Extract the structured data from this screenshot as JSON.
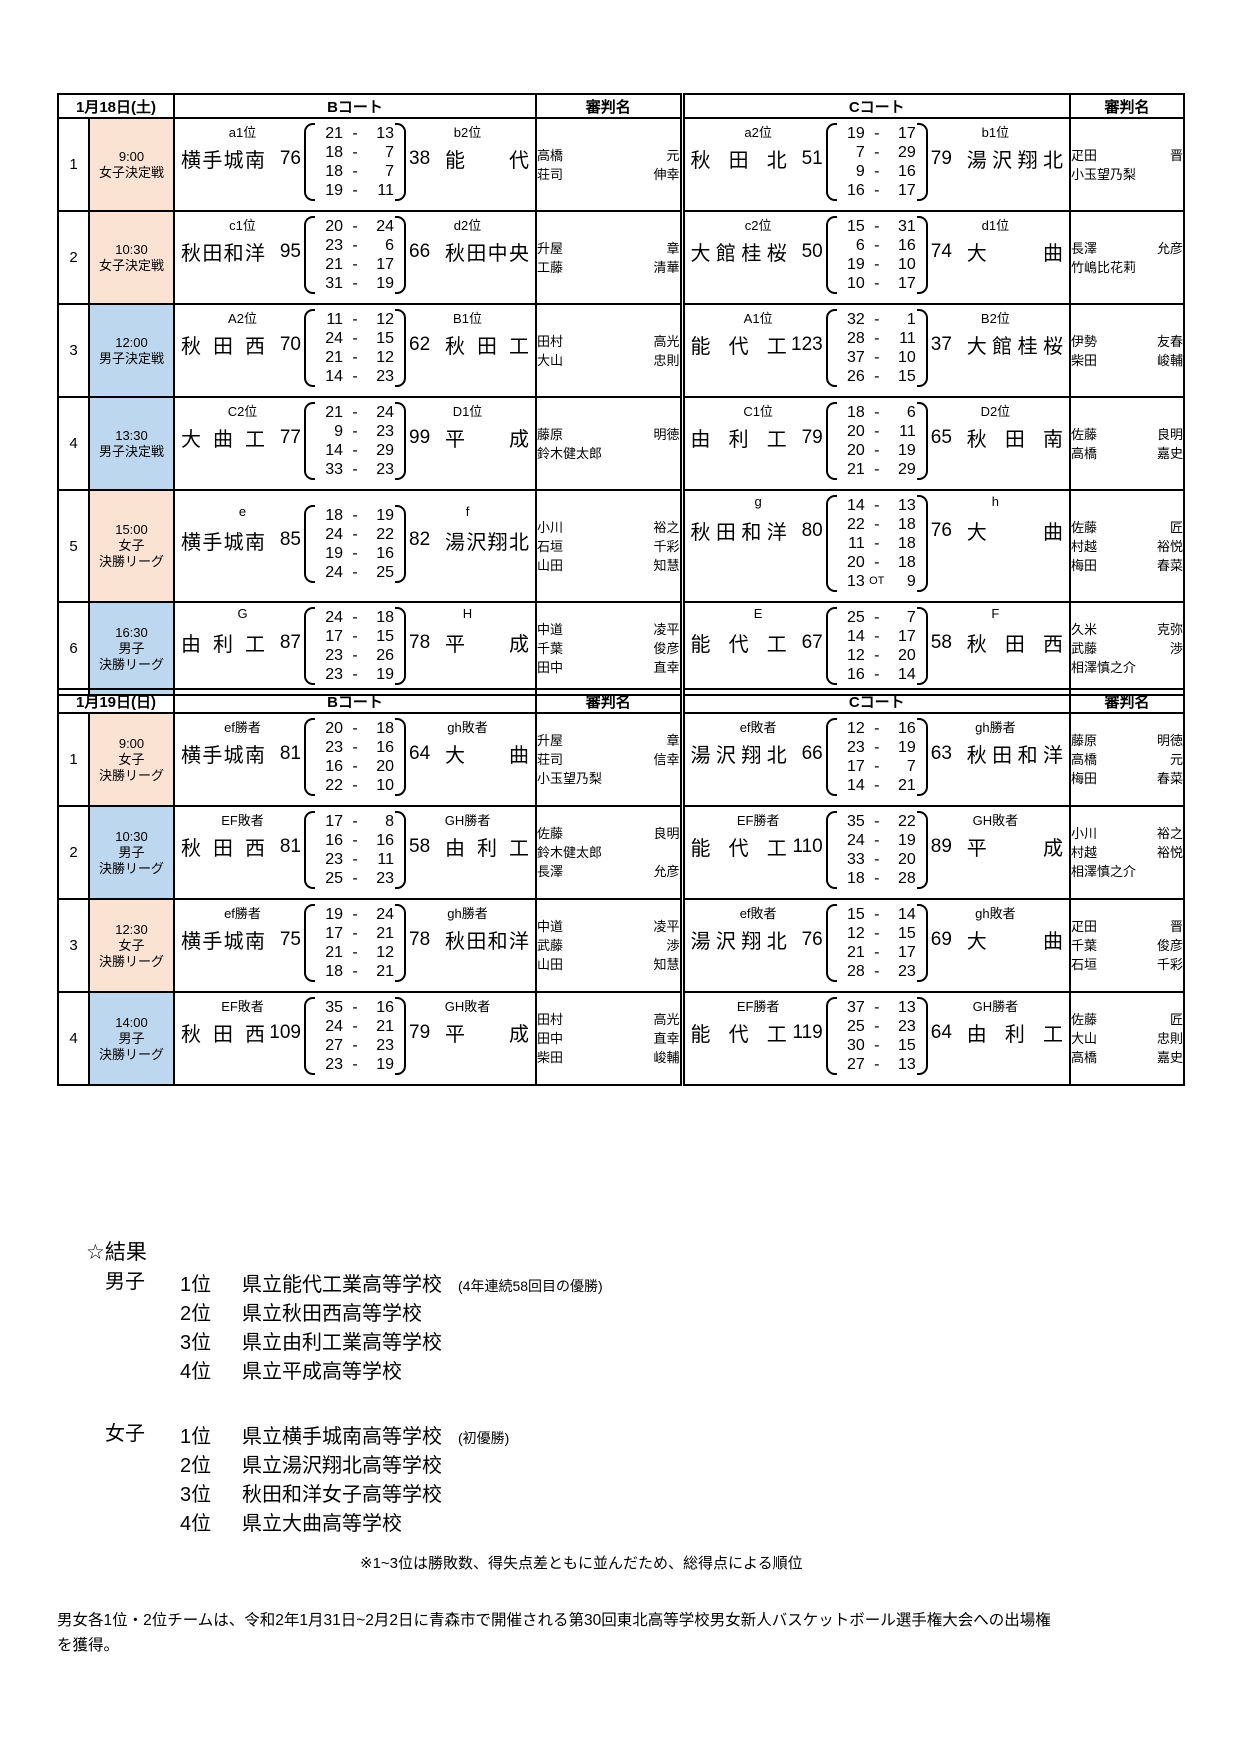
{
  "ui": {
    "dash": "-"
  },
  "colors": {
    "girls": "#fbe3d3",
    "boys": "#bdd7ee"
  },
  "day1": {
    "date": "1月18日(土)",
    "headers": {
      "court_b": "Bコート",
      "referee_b": "審判名",
      "court_c": "Cコート",
      "referee_c": "審判名"
    },
    "rows": [
      {
        "no": "1",
        "time": "9:00",
        "type_lines": [
          "女子決定戦"
        ],
        "gender": "girls",
        "b": {
          "seed_l": "a1位",
          "team_l": "横手城南",
          "score_l": "76",
          "quarters": [
            [
              "21",
              "13"
            ],
            [
              "18",
              "7"
            ],
            [
              "18",
              "7"
            ],
            [
              "19",
              "11"
            ]
          ],
          "score_r": "38",
          "team_r": "能代",
          "seed_r": "b2位",
          "refs": [
            [
              "高橋",
              "元"
            ],
            [
              "荘司",
              "伸幸"
            ]
          ]
        },
        "c": {
          "seed_l": "a2位",
          "team_l": "秋田北",
          "score_l": "51",
          "quarters": [
            [
              "19",
              "17"
            ],
            [
              "7",
              "29"
            ],
            [
              "9",
              "16"
            ],
            [
              "16",
              "17"
            ]
          ],
          "score_r": "79",
          "team_r": "湯沢翔北",
          "seed_r": "b1位",
          "refs": [
            [
              "疋田",
              "晋"
            ],
            [
              "小玉望乃梨"
            ]
          ]
        }
      },
      {
        "no": "2",
        "time": "10:30",
        "type_lines": [
          "女子決定戦"
        ],
        "gender": "girls",
        "b": {
          "seed_l": "c1位",
          "team_l": "秋田和洋",
          "score_l": "95",
          "quarters": [
            [
              "20",
              "24"
            ],
            [
              "23",
              "6"
            ],
            [
              "21",
              "17"
            ],
            [
              "31",
              "19"
            ]
          ],
          "score_r": "66",
          "team_r": "秋田中央",
          "seed_r": "d2位",
          "refs": [
            [
              "升屋",
              "章"
            ],
            [
              "工藤",
              "清華"
            ]
          ]
        },
        "c": {
          "seed_l": "c2位",
          "team_l": "大館桂桜",
          "score_l": "50",
          "quarters": [
            [
              "15",
              "31"
            ],
            [
              "6",
              "16"
            ],
            [
              "19",
              "10"
            ],
            [
              "10",
              "17"
            ]
          ],
          "score_r": "74",
          "team_r": "大曲",
          "seed_r": "d1位",
          "refs": [
            [
              "長澤",
              "允彦"
            ],
            [
              "竹嶋比花莉"
            ]
          ]
        }
      },
      {
        "no": "3",
        "time": "12:00",
        "type_lines": [
          "男子決定戦"
        ],
        "gender": "boys",
        "b": {
          "seed_l": "A2位",
          "team_l": "秋田西",
          "score_l": "70",
          "quarters": [
            [
              "11",
              "12"
            ],
            [
              "24",
              "15"
            ],
            [
              "21",
              "12"
            ],
            [
              "14",
              "23"
            ]
          ],
          "score_r": "62",
          "team_r": "秋田工",
          "seed_r": "B1位",
          "refs": [
            [
              "田村",
              "高光"
            ],
            [
              "大山",
              "忠則"
            ]
          ]
        },
        "c": {
          "seed_l": "A1位",
          "team_l": "能代工",
          "score_l": "123",
          "quarters": [
            [
              "32",
              "1"
            ],
            [
              "28",
              "11"
            ],
            [
              "37",
              "10"
            ],
            [
              "26",
              "15"
            ]
          ],
          "score_r": "37",
          "team_r": "大館桂桜",
          "seed_r": "B2位",
          "refs": [
            [
              "伊勢",
              "友春"
            ],
            [
              "柴田",
              "峻輔"
            ]
          ]
        }
      },
      {
        "no": "4",
        "time": "13:30",
        "type_lines": [
          "男子決定戦"
        ],
        "gender": "boys",
        "b": {
          "seed_l": "C2位",
          "team_l": "大曲工",
          "score_l": "77",
          "quarters": [
            [
              "21",
              "24"
            ],
            [
              "9",
              "23"
            ],
            [
              "14",
              "29"
            ],
            [
              "33",
              "23"
            ]
          ],
          "score_r": "99",
          "team_r": "平成",
          "seed_r": "D1位",
          "refs": [
            [
              "藤原",
              "明徳"
            ],
            [
              "鈴木健太郎"
            ]
          ]
        },
        "c": {
          "seed_l": "C1位",
          "team_l": "由利工",
          "score_l": "79",
          "quarters": [
            [
              "18",
              "6"
            ],
            [
              "20",
              "11"
            ],
            [
              "20",
              "19"
            ],
            [
              "21",
              "29"
            ]
          ],
          "score_r": "65",
          "team_r": "秋田南",
          "seed_r": "D2位",
          "refs": [
            [
              "佐藤",
              "良明"
            ],
            [
              "高橋",
              "嘉史"
            ]
          ]
        }
      },
      {
        "no": "5",
        "time": "15:00",
        "type_lines": [
          "女子",
          "決勝リーグ"
        ],
        "gender": "girls",
        "b": {
          "seed_l": "e",
          "team_l": "横手城南",
          "score_l": "85",
          "quarters": [
            [
              "18",
              "19"
            ],
            [
              "24",
              "22"
            ],
            [
              "19",
              "16"
            ],
            [
              "24",
              "25"
            ]
          ],
          "score_r": "82",
          "team_r": "湯沢翔北",
          "seed_r": "f",
          "refs": [
            [
              "小川",
              "裕之"
            ],
            [
              "石垣",
              "千彩"
            ],
            [
              "山田",
              "知慧"
            ]
          ]
        },
        "c": {
          "seed_l": "g",
          "team_l": "秋田和洋",
          "score_l": "80",
          "quarters": [
            [
              "14",
              "13"
            ],
            [
              "22",
              "18"
            ],
            [
              "11",
              "18"
            ],
            [
              "20",
              "18"
            ],
            [
              "13",
              "9",
              "OT"
            ]
          ],
          "score_r": "76",
          "team_r": "大曲",
          "seed_r": "h",
          "refs": [
            [
              "佐藤",
              "匠"
            ],
            [
              "村越",
              "裕悦"
            ],
            [
              "梅田",
              "春菜"
            ]
          ]
        }
      },
      {
        "no": "6",
        "time": "16:30",
        "type_lines": [
          "男子",
          "決勝リーグ"
        ],
        "gender": "boys",
        "b": {
          "seed_l": "G",
          "team_l": "由利工",
          "score_l": "87",
          "quarters": [
            [
              "24",
              "18"
            ],
            [
              "17",
              "15"
            ],
            [
              "23",
              "26"
            ],
            [
              "23",
              "19"
            ]
          ],
          "score_r": "78",
          "team_r": "平成",
          "seed_r": "H",
          "refs": [
            [
              "中道",
              "凌平"
            ],
            [
              "千葉",
              "俊彦"
            ],
            [
              "田中",
              "直幸"
            ]
          ]
        },
        "c": {
          "seed_l": "E",
          "team_l": "能代工",
          "score_l": "67",
          "quarters": [
            [
              "25",
              "7"
            ],
            [
              "14",
              "17"
            ],
            [
              "12",
              "20"
            ],
            [
              "16",
              "14"
            ]
          ],
          "score_r": "58",
          "team_r": "秋田西",
          "seed_r": "F",
          "refs": [
            [
              "久米",
              "克弥"
            ],
            [
              "武藤",
              "渉"
            ],
            [
              "相澤慎之介"
            ]
          ]
        }
      }
    ]
  },
  "day2": {
    "date": "1月19日(日)",
    "headers": {
      "court_b": "Bコート",
      "referee_b": "審判名",
      "court_c": "Cコート",
      "referee_c": "審判名"
    },
    "rows": [
      {
        "no": "1",
        "time": "9:00",
        "type_lines": [
          "女子",
          "決勝リーグ"
        ],
        "gender": "girls",
        "b": {
          "seed_l": "ef勝者",
          "team_l": "横手城南",
          "score_l": "81",
          "quarters": [
            [
              "20",
              "18"
            ],
            [
              "23",
              "16"
            ],
            [
              "16",
              "20"
            ],
            [
              "22",
              "10"
            ]
          ],
          "score_r": "64",
          "team_r": "大曲",
          "seed_r": "gh敗者",
          "refs": [
            [
              "升屋",
              "章"
            ],
            [
              "荘司",
              "信幸"
            ],
            [
              "小玉望乃梨"
            ]
          ]
        },
        "c": {
          "seed_l": "ef敗者",
          "team_l": "湯沢翔北",
          "score_l": "66",
          "quarters": [
            [
              "12",
              "16"
            ],
            [
              "23",
              "19"
            ],
            [
              "17",
              "7"
            ],
            [
              "14",
              "21"
            ]
          ],
          "score_r": "63",
          "team_r": "秋田和洋",
          "seed_r": "gh勝者",
          "refs": [
            [
              "藤原",
              "明徳"
            ],
            [
              "高橋",
              "元"
            ],
            [
              "梅田",
              "春菜"
            ]
          ]
        }
      },
      {
        "no": "2",
        "time": "10:30",
        "type_lines": [
          "男子",
          "決勝リーグ"
        ],
        "gender": "boys",
        "b": {
          "seed_l": "EF敗者",
          "team_l": "秋田西",
          "score_l": "81",
          "quarters": [
            [
              "17",
              "8"
            ],
            [
              "16",
              "16"
            ],
            [
              "23",
              "11"
            ],
            [
              "25",
              "23"
            ]
          ],
          "score_r": "58",
          "team_r": "由利工",
          "seed_r": "GH勝者",
          "refs": [
            [
              "佐藤",
              "良明"
            ],
            [
              "鈴木健太郎"
            ],
            [
              "長澤",
              "允彦"
            ]
          ]
        },
        "c": {
          "seed_l": "EF勝者",
          "team_l": "能代工",
          "score_l": "110",
          "quarters": [
            [
              "35",
              "22"
            ],
            [
              "24",
              "19"
            ],
            [
              "33",
              "20"
            ],
            [
              "18",
              "28"
            ]
          ],
          "score_r": "89",
          "team_r": "平成",
          "seed_r": "GH敗者",
          "refs": [
            [
              "小川",
              "裕之"
            ],
            [
              "村越",
              "裕悦"
            ],
            [
              "相澤慎之介"
            ]
          ]
        }
      },
      {
        "no": "3",
        "time": "12:30",
        "type_lines": [
          "女子",
          "決勝リーグ"
        ],
        "gender": "girls",
        "b": {
          "seed_l": "ef勝者",
          "team_l": "横手城南",
          "score_l": "75",
          "quarters": [
            [
              "19",
              "24"
            ],
            [
              "17",
              "21"
            ],
            [
              "21",
              "12"
            ],
            [
              "18",
              "21"
            ]
          ],
          "score_r": "78",
          "team_r": "秋田和洋",
          "seed_r": "gh勝者",
          "refs": [
            [
              "中道",
              "凌平"
            ],
            [
              "武藤",
              "渉"
            ],
            [
              "山田",
              "知慧"
            ]
          ]
        },
        "c": {
          "seed_l": "ef敗者",
          "team_l": "湯沢翔北",
          "score_l": "76",
          "quarters": [
            [
              "15",
              "14"
            ],
            [
              "12",
              "15"
            ],
            [
              "21",
              "17"
            ],
            [
              "28",
              "23"
            ]
          ],
          "score_r": "69",
          "team_r": "大曲",
          "seed_r": "gh敗者",
          "refs": [
            [
              "疋田",
              "晋"
            ],
            [
              "千葉",
              "俊彦"
            ],
            [
              "石垣",
              "千彩"
            ]
          ]
        }
      },
      {
        "no": "4",
        "time": "14:00",
        "type_lines": [
          "男子",
          "決勝リーグ"
        ],
        "gender": "boys",
        "b": {
          "seed_l": "EF敗者",
          "team_l": "秋田西",
          "score_l": "109",
          "quarters": [
            [
              "35",
              "16"
            ],
            [
              "24",
              "21"
            ],
            [
              "27",
              "23"
            ],
            [
              "23",
              "19"
            ]
          ],
          "score_r": "79",
          "team_r": "平成",
          "seed_r": "GH敗者",
          "refs": [
            [
              "田村",
              "高光"
            ],
            [
              "田中",
              "直幸"
            ],
            [
              "柴田",
              "峻輔"
            ]
          ]
        },
        "c": {
          "seed_l": "EF勝者",
          "team_l": "能代工",
          "score_l": "119",
          "quarters": [
            [
              "37",
              "13"
            ],
            [
              "25",
              "23"
            ],
            [
              "30",
              "15"
            ],
            [
              "27",
              "13"
            ]
          ],
          "score_r": "64",
          "team_r": "由利工",
          "seed_r": "GH勝者",
          "refs": [
            [
              "佐藤",
              "匠"
            ],
            [
              "大山",
              "忠則"
            ],
            [
              "高橋",
              "嘉史"
            ]
          ]
        }
      }
    ]
  },
  "results": {
    "heading": "☆結果",
    "boys": {
      "label": "男子",
      "ranks": [
        {
          "rank": "1位",
          "school": "県立能代工業高等学校",
          "note": "(4年連続58回目の優勝)"
        },
        {
          "rank": "2位",
          "school": "県立秋田西高等学校"
        },
        {
          "rank": "3位",
          "school": "県立由利工業高等学校"
        },
        {
          "rank": "4位",
          "school": "県立平成高等学校"
        }
      ]
    },
    "girls": {
      "label": "女子",
      "ranks": [
        {
          "rank": "1位",
          "school": "県立横手城南高等学校",
          "note": "(初優勝)"
        },
        {
          "rank": "2位",
          "school": "県立湯沢翔北高等学校"
        },
        {
          "rank": "3位",
          "school": "秋田和洋女子高等学校"
        },
        {
          "rank": "4位",
          "school": "県立大曲高等学校"
        }
      ]
    },
    "note": "※1~3位は勝敗数、得失点差ともに並んだため、総得点による順位"
  },
  "footer": "男女各1位・2位チームは、令和2年1月31日~2月2日に青森市で開催される第30回東北高等学校男女新人バスケットボール選手権大会への出場権を獲得。"
}
